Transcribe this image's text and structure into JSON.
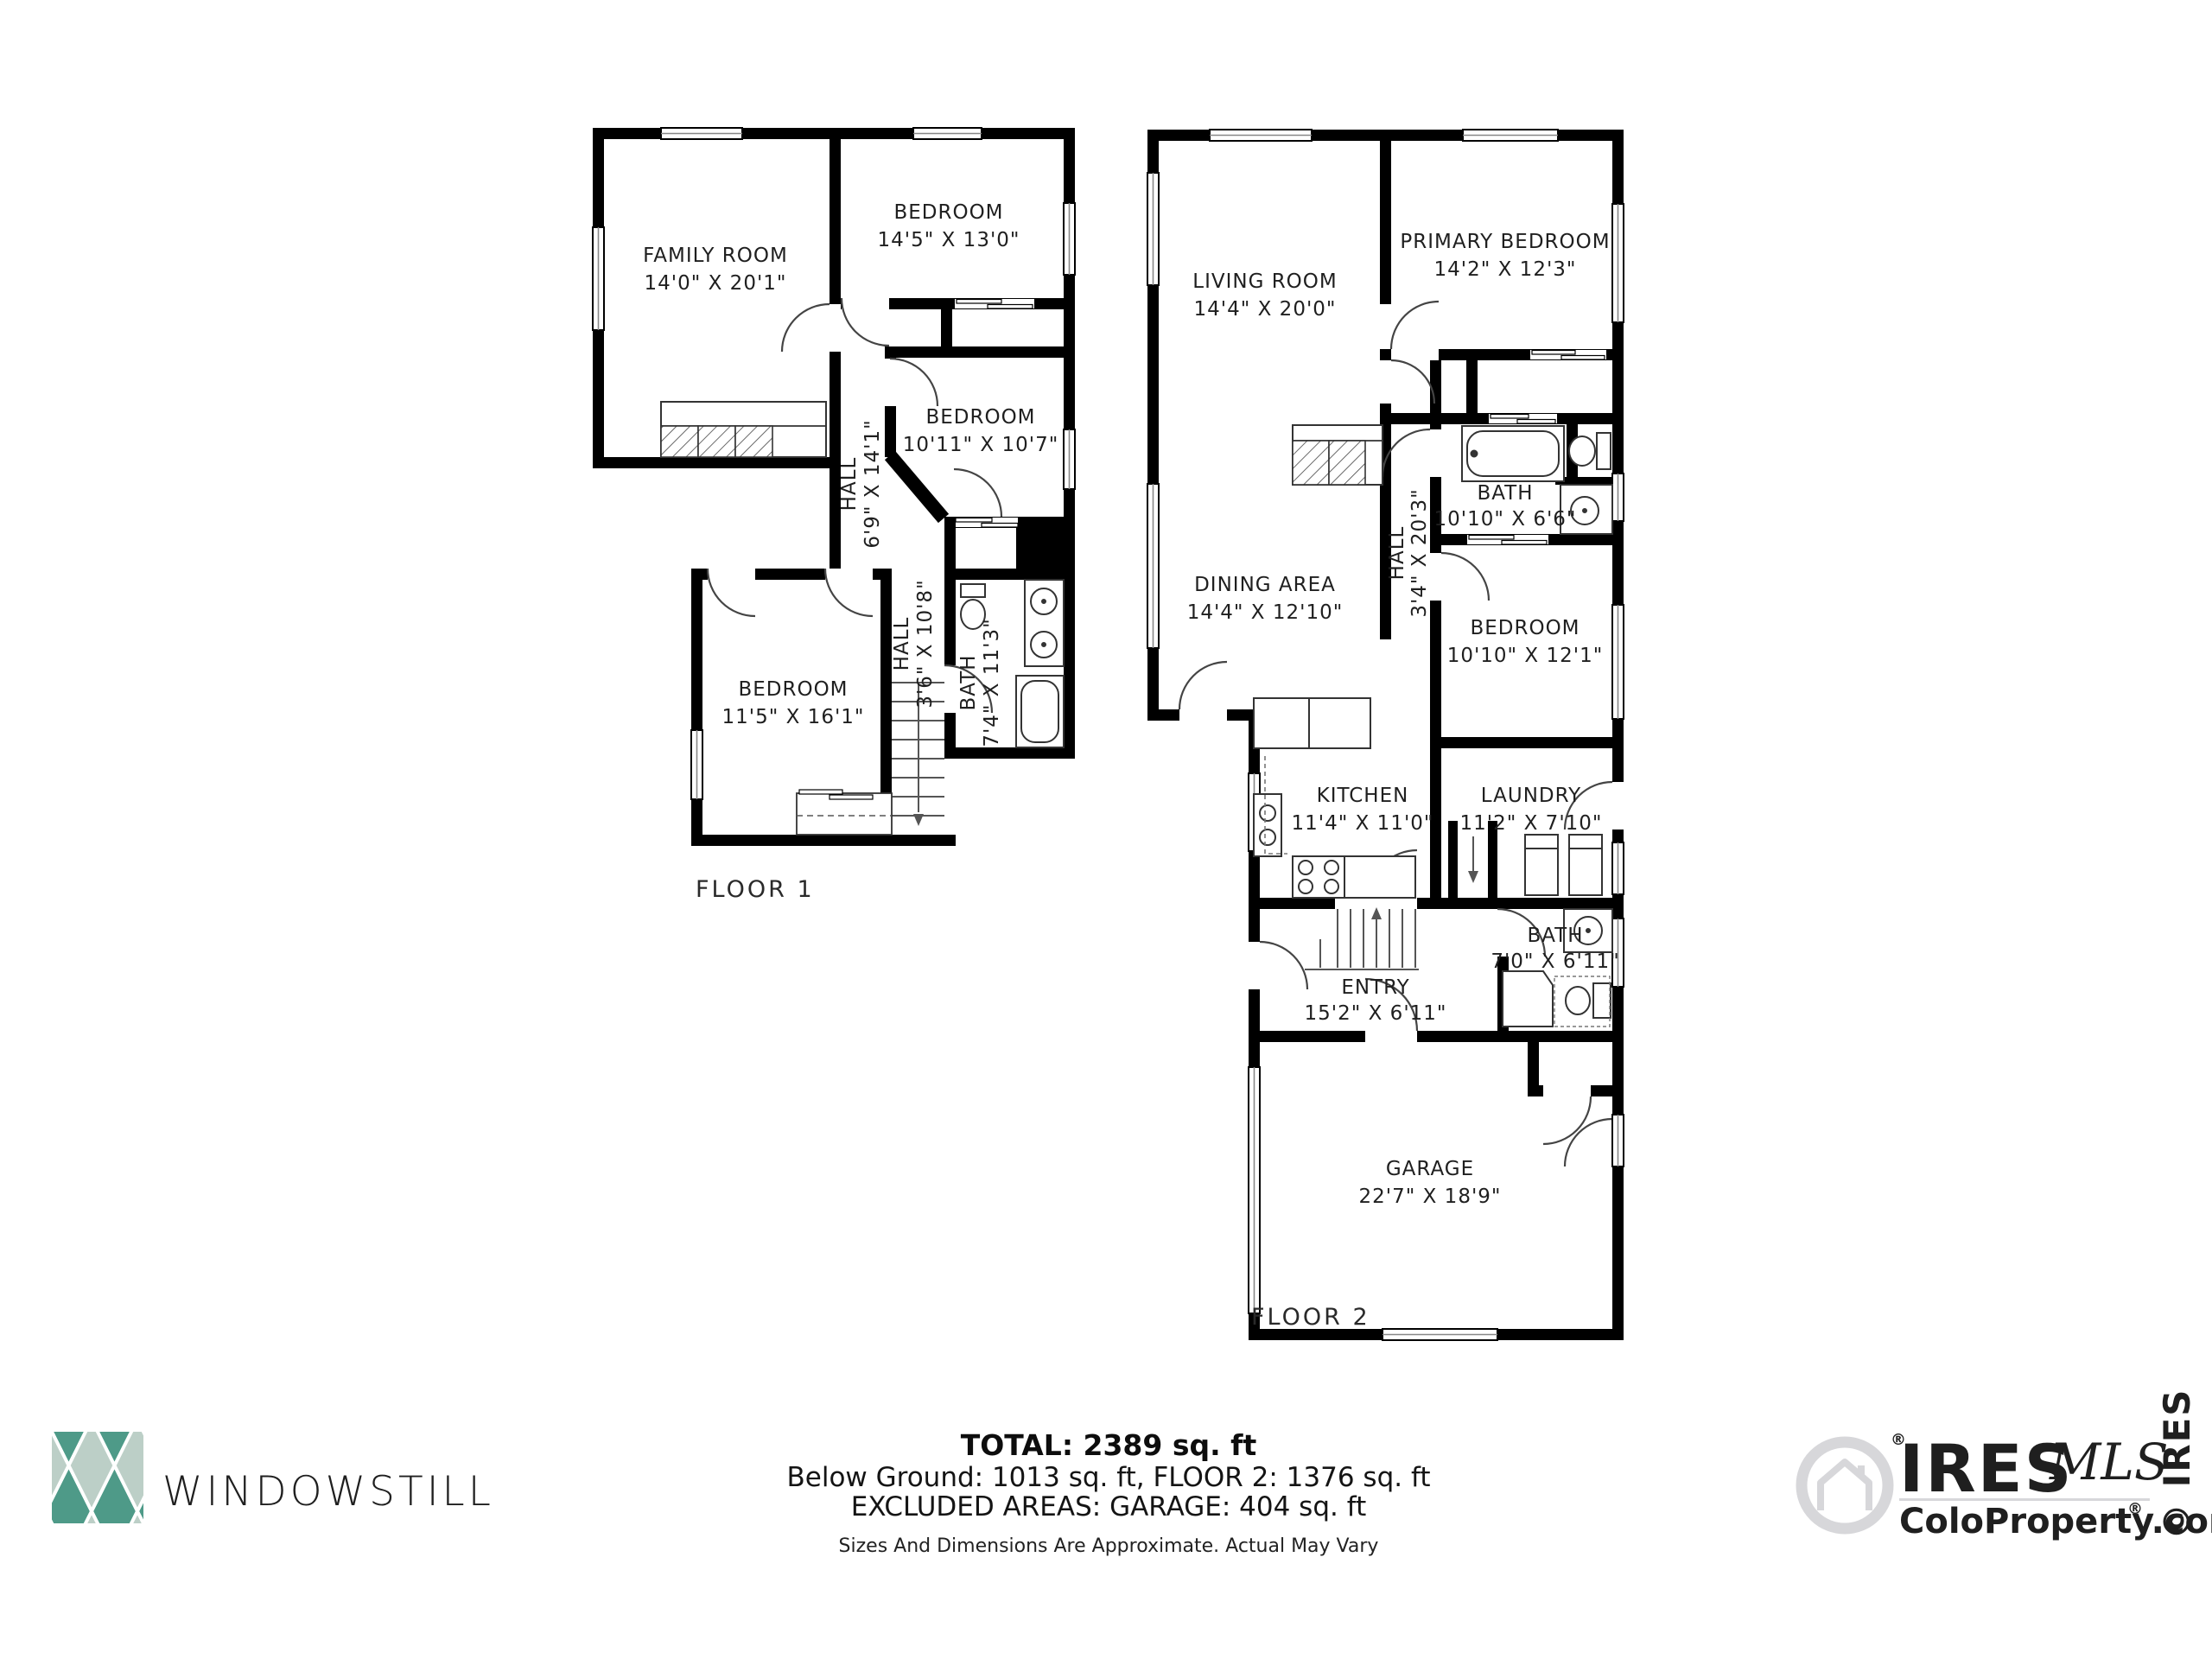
{
  "floor1": {
    "label": "FLOOR 1",
    "rooms": {
      "family_room": {
        "name": "FAMILY ROOM",
        "dims": "14'0\" X 20'1\""
      },
      "bedroom_a": {
        "name": "BEDROOM",
        "dims": "14'5\" X 13'0\""
      },
      "bedroom_b": {
        "name": "BEDROOM",
        "dims": "10'11\" X 10'7\""
      },
      "hall_a": {
        "name": "HALL",
        "dims": "6'9\" X 14'1\""
      },
      "hall_b": {
        "name": "HALL",
        "dims": "3'6\" X 10'8\""
      },
      "bath": {
        "name": "BATH",
        "dims": "7'4\" X 11'3\""
      },
      "bedroom_c": {
        "name": "BEDROOM",
        "dims": "11'5\" X 16'1\""
      }
    }
  },
  "floor2": {
    "label": "FLOOR 2",
    "rooms": {
      "living_room": {
        "name": "LIVING ROOM",
        "dims": "14'4\" X 20'0\""
      },
      "primary_bedroom": {
        "name": "PRIMARY BEDROOM",
        "dims": "14'2\" X 12'3\""
      },
      "dining_area": {
        "name": "DINING AREA",
        "dims": "14'4\" X 12'10\""
      },
      "hall": {
        "name": "HALL",
        "dims": "3'4\" X 20'3\""
      },
      "bath_a": {
        "name": "BATH",
        "dims": "10'10\" X 6'6\""
      },
      "bedroom": {
        "name": "BEDROOM",
        "dims": "10'10\" X 12'1\""
      },
      "kitchen": {
        "name": "KITCHEN",
        "dims": "11'4\" X 11'0\""
      },
      "laundry": {
        "name": "LAUNDRY",
        "dims": "11'2\" X 7'10\""
      },
      "entry": {
        "name": "ENTRY",
        "dims": "15'2\" X 6'11\""
      },
      "bath_b": {
        "name": "BATH",
        "dims": "7'0\" X 6'11\""
      },
      "garage": {
        "name": "GARAGE",
        "dims": "22'7\" X 18'9\""
      }
    }
  },
  "summary": {
    "total": "TOTAL: 2389 sq. ft",
    "breakdown": "Below Ground: 1013 sq. ft, FLOOR 2: 1376 sq. ft",
    "excluded": "EXCLUDED AREAS: GARAGE: 404 sq. ft",
    "disclaimer": "Sizes And Dimensions Are Approximate. Actual May Vary"
  },
  "branding": {
    "windowstill_wordmark": "WINDOWSTILL",
    "ires_wordmark": "IRES",
    "ires_mls": "MLS",
    "ires_site": "ColoProperty.com",
    "ires_registered": "®",
    "ires_copyright_vertical": "© IRES",
    "colors": {
      "windowstill_teal": "#559B8A",
      "windowstill_dark_diamond": "#4E9A88",
      "windowstill_light_diamond": "#BCCFC7",
      "watermark_gray": "#D7D7DA",
      "wall_black": "#000000"
    }
  }
}
